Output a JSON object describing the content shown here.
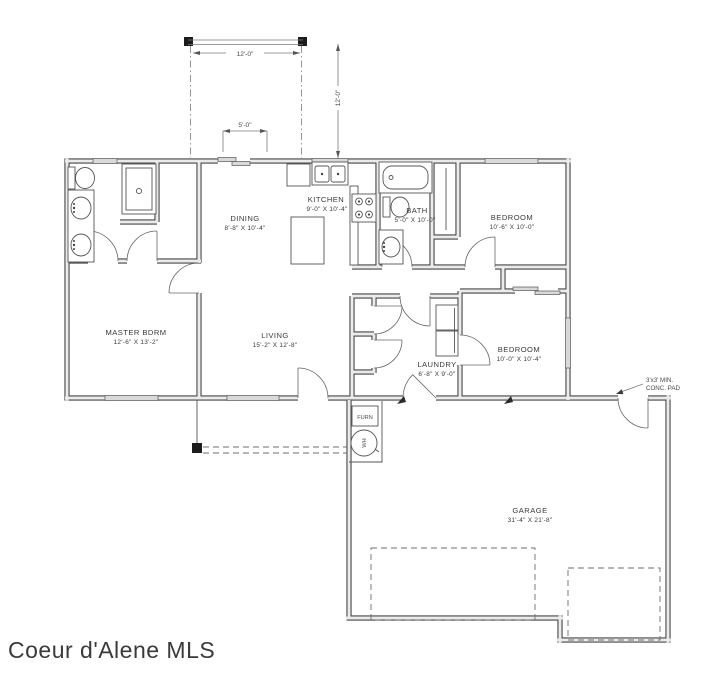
{
  "watermark": "Coeur d'Alene MLS",
  "rooms": {
    "dining": {
      "name": "DINING",
      "dims": "8'-8\" X 10'-4\""
    },
    "kitchen": {
      "name": "KITCHEN",
      "dims": "9'-0\" X 10'-4\""
    },
    "bath": {
      "name": "BATH",
      "dims": "5'-0\" X 10'-0\""
    },
    "bedroom1": {
      "name": "BEDROOM",
      "dims": "10'-6\" X 10'-0\""
    },
    "master": {
      "name": "MASTER BDRM",
      "dims": "12'-6\" X 13'-2\""
    },
    "living": {
      "name": "LIVING",
      "dims": "15'-2\" X 12'-8\""
    },
    "laundry": {
      "name": "LAUNDRY",
      "dims": "6'-8\" X 9'-0\""
    },
    "bedroom2": {
      "name": "BEDROOM",
      "dims": "10'-0\" X 10'-4\""
    },
    "garage": {
      "name": "GARAGE",
      "dims": "31'-4\" X 21'-8\""
    }
  },
  "equipment": {
    "furnace": "FURN",
    "water_heater": "WH"
  },
  "dimensions": {
    "deck_width": "12'-0\"",
    "deck_depth": "12'-0\"",
    "slider_width": "5'-0\""
  },
  "notes": {
    "conc_pad_line1": "3'x3' MIN.",
    "conc_pad_line2": "CONC. PAD"
  },
  "colors": {
    "line": "#474747",
    "wall_fill": "#ebebeb",
    "watermark": "#b6b6b6",
    "background": "#ffffff"
  }
}
